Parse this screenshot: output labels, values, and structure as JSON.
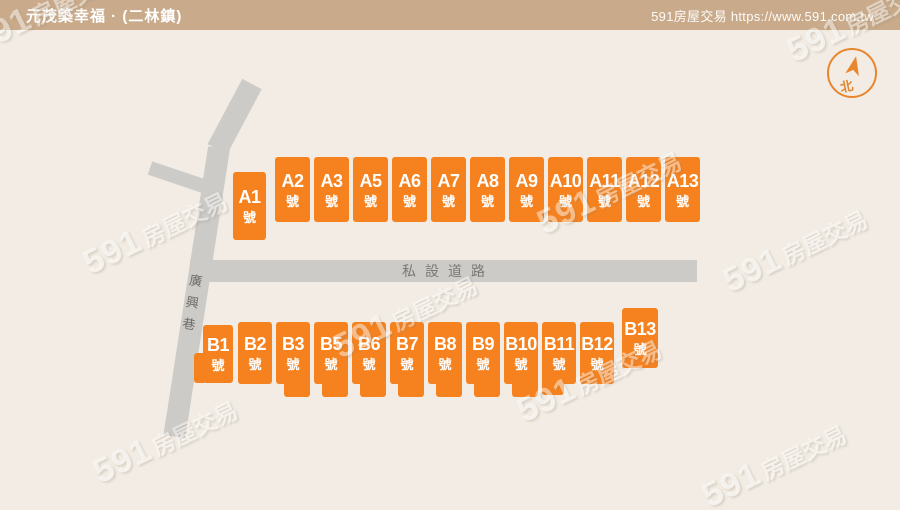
{
  "header": {
    "title": "元茂築幸福 · (二林鎮)",
    "site": "591房屋交易 https://www.591.com.tw"
  },
  "map": {
    "roads": {
      "horizontal_label": "私設道路",
      "vertical_label": "廣興巷",
      "vertical_chars": {
        "c1": "廣",
        "c2": "興",
        "c3": "巷"
      }
    },
    "compass": {
      "north_label": "北"
    },
    "watermark": {
      "number": "591",
      "text": "房屋交易"
    },
    "blocks_a": [
      {
        "id": "A1",
        "suffix": "號"
      },
      {
        "id": "A2",
        "suffix": "號"
      },
      {
        "id": "A3",
        "suffix": "號"
      },
      {
        "id": "A5",
        "suffix": "號"
      },
      {
        "id": "A6",
        "suffix": "號"
      },
      {
        "id": "A7",
        "suffix": "號"
      },
      {
        "id": "A8",
        "suffix": "號"
      },
      {
        "id": "A9",
        "suffix": "號"
      },
      {
        "id": "A10",
        "suffix": "號"
      },
      {
        "id": "A11",
        "suffix": "號"
      },
      {
        "id": "A12",
        "suffix": "號"
      },
      {
        "id": "A13",
        "suffix": "號"
      }
    ],
    "blocks_b": [
      {
        "id": "B1",
        "suffix": "號"
      },
      {
        "id": "B2",
        "suffix": "號"
      },
      {
        "id": "B3",
        "suffix": "號"
      },
      {
        "id": "B5",
        "suffix": "號"
      },
      {
        "id": "B6",
        "suffix": "號"
      },
      {
        "id": "B7",
        "suffix": "號"
      },
      {
        "id": "B8",
        "suffix": "號"
      },
      {
        "id": "B9",
        "suffix": "號"
      },
      {
        "id": "B10",
        "suffix": "號"
      },
      {
        "id": "B11",
        "suffix": "號"
      },
      {
        "id": "B12",
        "suffix": "號"
      },
      {
        "id": "B13",
        "suffix": "號"
      }
    ]
  },
  "colors": {
    "block_orange": "#f6821f",
    "header_tan": "#c9ab8b",
    "map_background": "#f2ece4",
    "road_gray": "#cccbc8",
    "compass_orange": "#e8862d"
  }
}
